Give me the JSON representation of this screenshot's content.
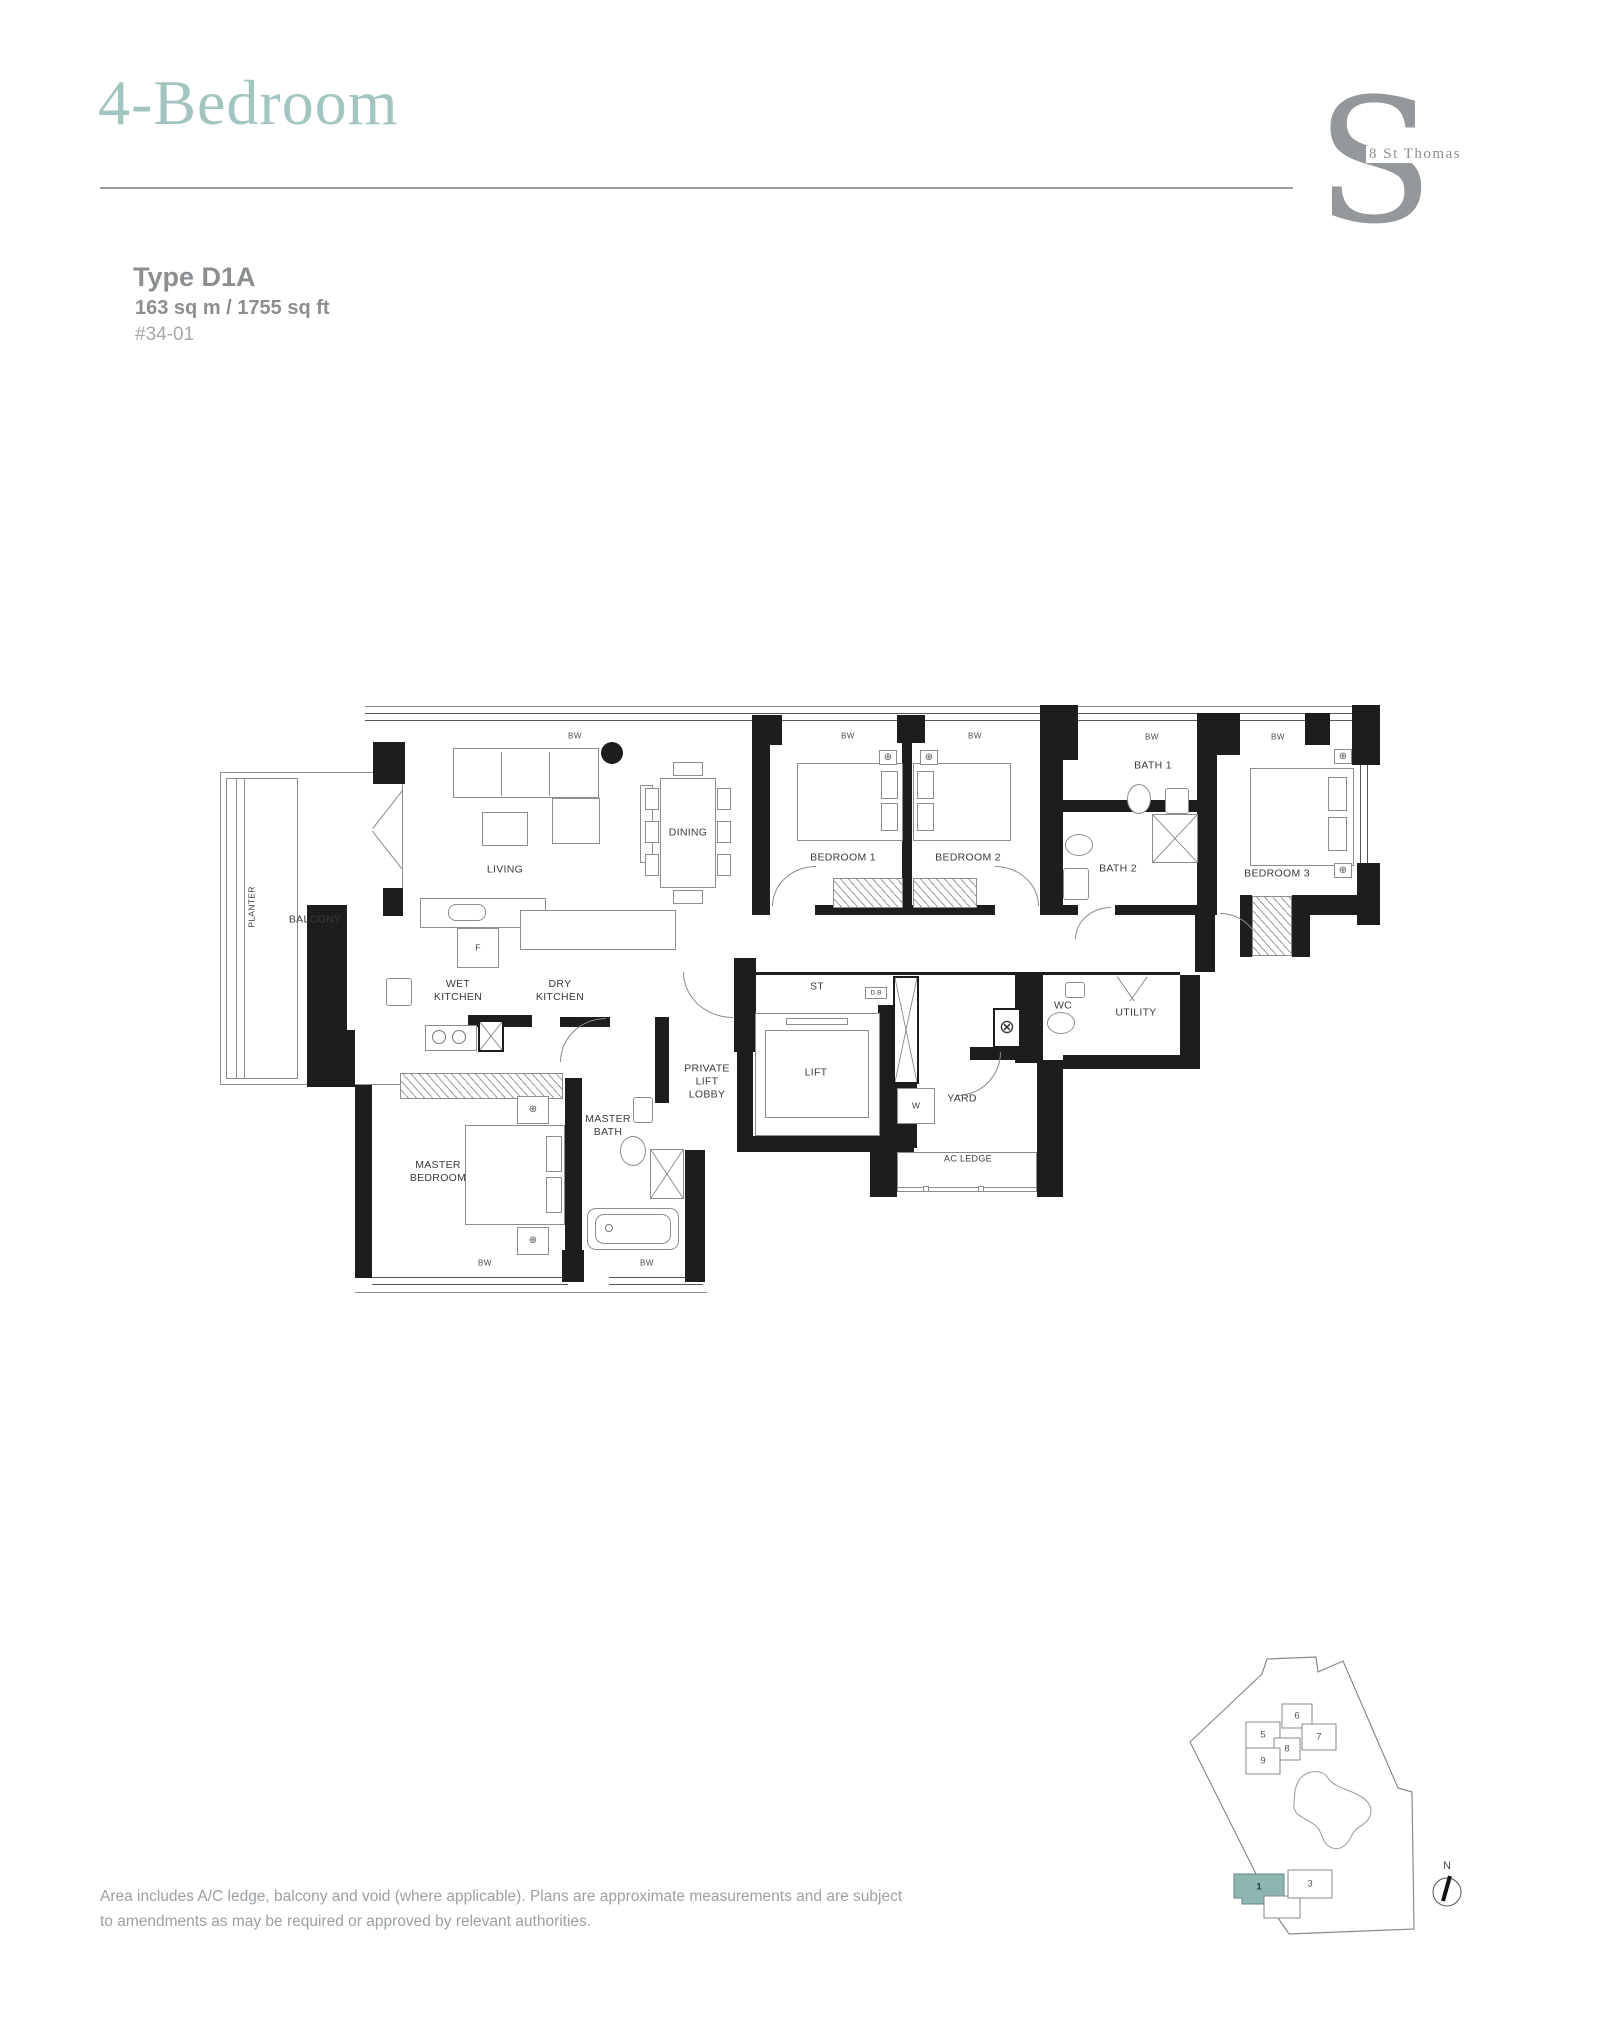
{
  "header": {
    "title": "4-Bedroom",
    "logo_mark": "S",
    "logo_text": "8 St Thomas"
  },
  "unit_info": {
    "type_label": "Type D1A",
    "area": "163 sq m / 1755 sq ft",
    "unit_number": "#34-01"
  },
  "floor_plan": {
    "window_label_text": "BW",
    "rooms": [
      {
        "id": "living",
        "label": "LIVING",
        "x": 285,
        "y": 170
      },
      {
        "id": "dining",
        "label": "DINING",
        "x": 468,
        "y": 133,
        "cls": "boxed"
      },
      {
        "id": "balcony",
        "label": "BALCONY",
        "x": 95,
        "y": 220
      },
      {
        "id": "planter",
        "label": "PLANTER",
        "x": 32,
        "y": 207,
        "cls": "rot tag"
      },
      {
        "id": "wet-kitchen",
        "label": "WET\nKITCHEN",
        "x": 238,
        "y": 291
      },
      {
        "id": "dry-kitchen",
        "label": "DRY\nKITCHEN",
        "x": 340,
        "y": 291
      },
      {
        "id": "bedroom-1",
        "label": "BEDROOM 1",
        "x": 623,
        "y": 158
      },
      {
        "id": "bedroom-2",
        "label": "BEDROOM 2",
        "x": 748,
        "y": 158
      },
      {
        "id": "bedroom-3",
        "label": "BEDROOM 3",
        "x": 1057,
        "y": 174
      },
      {
        "id": "bath-1",
        "label": "BATH 1",
        "x": 933,
        "y": 66
      },
      {
        "id": "bath-2",
        "label": "BATH 2",
        "x": 898,
        "y": 169
      },
      {
        "id": "master-bedroom",
        "label": "MASTER\nBEDROOM",
        "x": 218,
        "y": 472
      },
      {
        "id": "master-bath",
        "label": "MASTER\nBATH",
        "x": 388,
        "y": 426
      },
      {
        "id": "private-lift-lobby",
        "label": "PRIVATE\nLIFT\nLOBBY",
        "x": 487,
        "y": 382
      },
      {
        "id": "lift",
        "label": "LIFT",
        "x": 596,
        "y": 373
      },
      {
        "id": "st",
        "label": "ST",
        "x": 597,
        "y": 287
      },
      {
        "id": "wc",
        "label": "WC",
        "x": 843,
        "y": 306
      },
      {
        "id": "utility",
        "label": "UTILITY",
        "x": 916,
        "y": 313
      },
      {
        "id": "yard",
        "label": "YARD",
        "x": 742,
        "y": 399
      },
      {
        "id": "ac-ledge",
        "label": "AC LEDGE",
        "x": 748,
        "y": 459,
        "cls": "sm"
      }
    ],
    "equipment_tags": [
      {
        "id": "fridge",
        "text": "F",
        "x": 258,
        "y": 248
      },
      {
        "id": "washer",
        "text": "W",
        "x": 696,
        "y": 406
      },
      {
        "id": "distribution-board",
        "text": "D.B",
        "x": 656,
        "y": 293,
        "cls": "xs"
      }
    ],
    "window_labels": [
      {
        "x": 355,
        "y": 36
      },
      {
        "x": 628,
        "y": 36
      },
      {
        "x": 755,
        "y": 36
      },
      {
        "x": 932,
        "y": 37
      },
      {
        "x": 1058,
        "y": 37
      },
      {
        "x": 265,
        "y": 563
      },
      {
        "x": 427,
        "y": 563
      }
    ]
  },
  "site_plan": {
    "north_label": "N",
    "highlighted_unit": "1",
    "units": [
      {
        "number": "5",
        "x": 113,
        "y": 105
      },
      {
        "number": "6",
        "x": 147,
        "y": 86
      },
      {
        "number": "7",
        "x": 169,
        "y": 107
      },
      {
        "number": "8",
        "x": 137,
        "y": 119
      },
      {
        "number": "9",
        "x": 113,
        "y": 131
      },
      {
        "number": "1",
        "x": 109,
        "y": 257,
        "highlighted": true
      },
      {
        "number": "3",
        "x": 160,
        "y": 254
      }
    ]
  },
  "footer": {
    "disclaimer_line1": "Area includes A/C ledge, balcony and void (where applicable). Plans are approximate measurements and are subject",
    "disclaimer_line2": "to amendments as may be required or approved by relevant authorities."
  },
  "colors": {
    "accent_teal": "#a3c5c1",
    "logo_gray": "#94989b",
    "heading_gray": "#8b8e90",
    "muted_gray": "#a4a8aa",
    "plan_line": "#1d1d1d",
    "unit_highlight_fill": "#8fb5b0",
    "unit_highlight_border": "#5f8a86"
  }
}
